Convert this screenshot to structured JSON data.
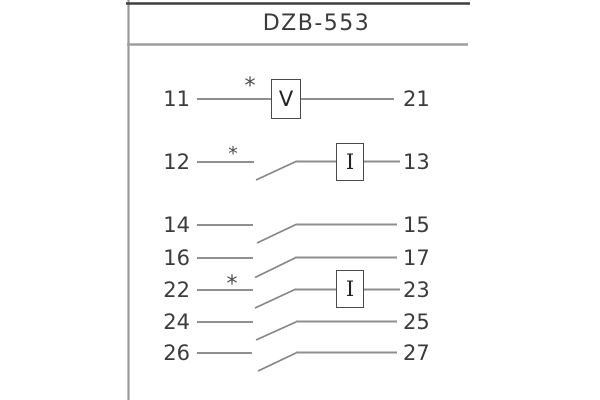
{
  "title": "DZB-553",
  "colors": {
    "background": "#ffffff",
    "frame_top": "#3f3f3f",
    "frame_gray": "#9a9a9a",
    "wire": "#8f8f8f",
    "box_border": "#4a4a4a",
    "text": "#3b3b3b"
  },
  "diagram": {
    "rows": [
      {
        "left": "11",
        "right": "21",
        "marker": "*",
        "element": "V"
      },
      {
        "left": "12",
        "right": "13",
        "marker": "*",
        "element": "I",
        "switch": true
      },
      {
        "left": "14",
        "right": "15",
        "switch": true
      },
      {
        "left": "16",
        "right": "17",
        "switch": true
      },
      {
        "left": "22",
        "right": "23",
        "marker": "*",
        "element": "I",
        "switch": true
      },
      {
        "left": "24",
        "right": "25",
        "switch": true
      },
      {
        "left": "26",
        "right": "27",
        "switch": true
      }
    ]
  }
}
